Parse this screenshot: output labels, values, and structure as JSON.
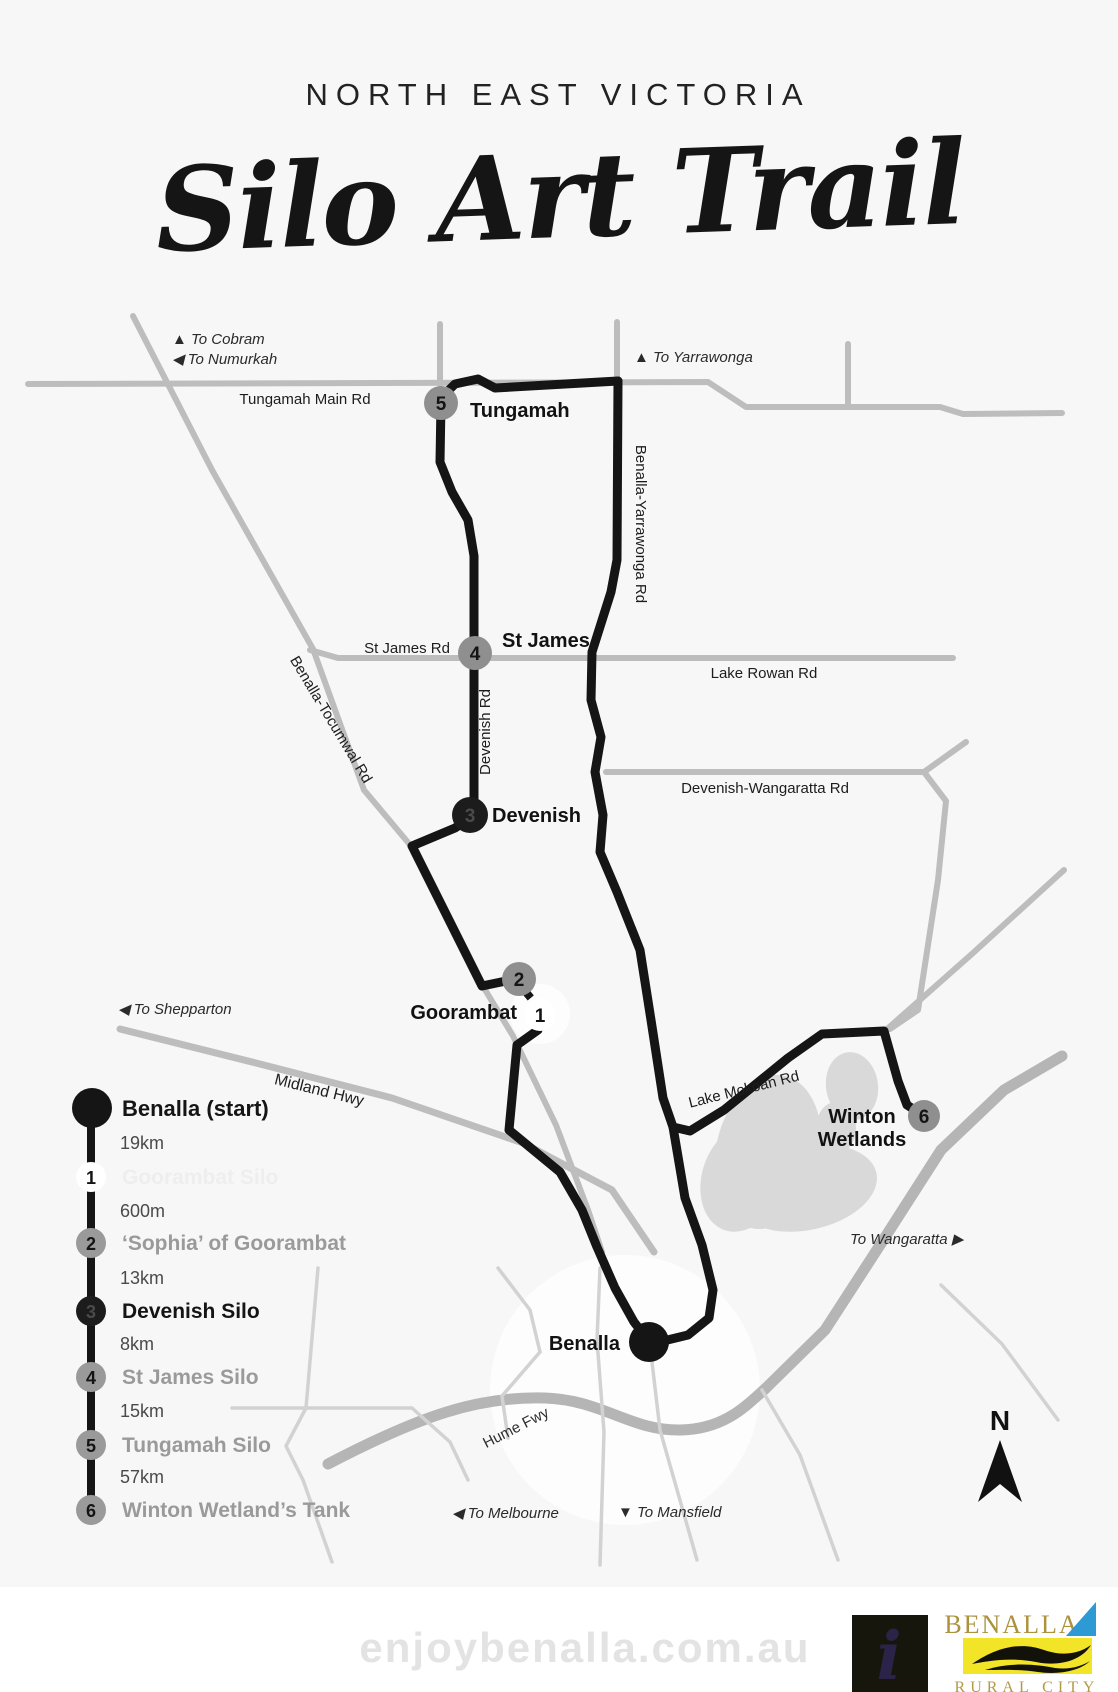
{
  "header": {
    "region": "NORTH EAST VICTORIA",
    "title": "Silo Art Trail"
  },
  "map": {
    "towns": {
      "tungamah": "Tungamah",
      "st_james": "St James",
      "devenish": "Devenish",
      "goorambat": "Goorambat",
      "benalla": "Benalla",
      "winton_line1": "Winton",
      "winton_line2": "Wetlands"
    },
    "road_labels": {
      "tungamah_main": "Tungamah Main Rd",
      "st_james_rd": "St James Rd",
      "lake_rowan": "Lake Rowan Rd",
      "devenish_wangaratta": "Devenish-Wangaratta Rd",
      "devenish_rd": "Devenish Rd",
      "benalla_yarrawonga": "Benalla-Yarrawonga Rd",
      "benalla_tocumwal": "Benalla-Tocumwal Rd",
      "midland": "Midland Hwy",
      "lake_mokoan": "Lake Mokoan Rd",
      "hume": "Hume Fwy"
    },
    "directions": {
      "cobram": "▲ To Cobram",
      "numurkah": "◀ To Numurkah",
      "yarrawonga": "▲ To Yarrawonga",
      "shepparton": "◀ To Shepparton",
      "wangaratta": "To Wangaratta ▶",
      "melbourne": "◀ To Melbourne",
      "mansfield": "▼ To Mansfield"
    },
    "markers": {
      "m1": "1",
      "m2": "2",
      "m3": "3",
      "m4": "4",
      "m5": "5",
      "m6": "6"
    },
    "compass": "N"
  },
  "legend": {
    "start_label": "Benalla (start)",
    "items": [
      {
        "num": "1",
        "label": "Goorambat Silo"
      },
      {
        "num": "2",
        "label": "‘Sophia’ of Goorambat"
      },
      {
        "num": "3",
        "label": "Devenish Silo"
      },
      {
        "num": "4",
        "label": "St James Silo"
      },
      {
        "num": "5",
        "label": "Tungamah Silo"
      },
      {
        "num": "6",
        "label": "Winton Wetland’s Tank"
      }
    ],
    "distances": [
      "19km",
      "600m",
      "13km",
      "8km",
      "15km",
      "57km"
    ]
  },
  "footer": {
    "watermark": "enjoybenalla.com.au",
    "info_symbol": "i",
    "logo_title": "BENALLA",
    "logo_subtitle": "RURAL CITY"
  },
  "colors": {
    "trail": "#151515",
    "road": "#bdbdbd",
    "marker_gray": "#8f8f8f",
    "marker_black": "#1c1c1c",
    "marker_white": "#ffffff",
    "wetland": "#d9d9d9",
    "logo_gold": "#ab923d",
    "logo_yellow": "#f2e426",
    "logo_blue": "#2e9ad3"
  }
}
